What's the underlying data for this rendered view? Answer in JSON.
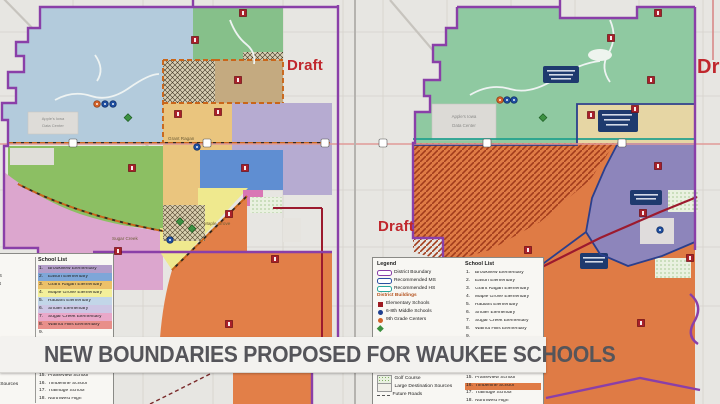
{
  "banner": {
    "text": "NEW BOUNDARIES PROPOSED FOR WAUKEE SCHOOLS"
  },
  "draft": "Draft",
  "legend": {
    "legend_header": "Legend",
    "school_list_header": "School List",
    "boundaries": [
      {
        "label": "District Boundary",
        "color": "#8a3fa8"
      },
      {
        "label": "Recommended MS",
        "color": "#2b4fa2"
      },
      {
        "label": "Recommended HS",
        "color": "#2aa79b"
      }
    ],
    "buildings_header": "District Buildings",
    "buildings": [
      {
        "label": "Elementary Schools",
        "color": "#9e1b22",
        "shape": "square"
      },
      {
        "label": "6-8th Middle Schools",
        "color": "#1f3f8f",
        "shape": "circle"
      },
      {
        "label": "9th Grade Centers",
        "color": "#d2622a",
        "shape": "circle"
      },
      {
        "label": "",
        "color": "#3a8f3e",
        "shape": "diamond"
      }
    ],
    "areas": [
      {
        "label": "Golf Course"
      },
      {
        "label": "Large Destination Sources"
      },
      {
        "label": "Future Roads"
      }
    ],
    "schools_upper": [
      {
        "num": "1.",
        "name": "Brookview Elementary",
        "hl": "#b39dc9"
      },
      {
        "num": "2.",
        "name": "Eason Elementary",
        "hl": "#7ea6d8"
      },
      {
        "num": "3.",
        "name": "Grant Ragan Elementary",
        "hl": "#ecc169"
      },
      {
        "num": "4.",
        "name": "Maple Grove Elementary",
        "hl": "#f3ef9a"
      },
      {
        "num": "5.",
        "name": "Radiant Elementary",
        "hl": "#c2d6e8"
      },
      {
        "num": "6.",
        "name": "Shuler Elementary",
        "hl": "#cdc6e4"
      },
      {
        "num": "7.",
        "name": "Sugar Creek Elementary",
        "hl": "#e9a8c9"
      },
      {
        "num": "8.",
        "name": "Walnut Hills Elementary",
        "hl": "#e88f8a"
      },
      {
        "num": "9.",
        "name": "",
        "hl": ""
      }
    ],
    "schools_lower": [
      {
        "num": "15.",
        "name": "Prairieview School"
      },
      {
        "num": "16.",
        "name": "Timberline School",
        "hl_right": "#e07b45"
      },
      {
        "num": "17.",
        "name": "Trailridge School"
      },
      {
        "num": "18.",
        "name": "Northwest High"
      }
    ]
  },
  "map_labels": {
    "data_center_line1": "Apple's Iowa",
    "data_center_line2": "Data Center",
    "grant_ragan": "Grant Ragan",
    "sugar_creek": "Sugar Creek",
    "maple_grove": "Maple Grove"
  },
  "palette": {
    "paper": "#e7e6e2",
    "radiant_blue": "#b3cbdc",
    "north_green": "#86c08a",
    "tan": "#c4aa80",
    "grant_ragan_gold": "#eac57e",
    "shuler_lavender": "#b6abd1",
    "eason_blue": "#5f8ed2",
    "west_green": "#8cbf63",
    "sugar_creek_pink": "#dca6ce",
    "maple_grove_yellow": "#efe98e",
    "brookview_purple": "#998cc4",
    "orange_zone": "#e27f48",
    "magenta_patch": "#d977b5",
    "right_green": "#8fc9a1",
    "right_tan": "#e6d6a4",
    "right_purple": "#8d85bb",
    "right_orange": "#df7b45",
    "district_boundary": "#8a3fa8",
    "recommended_ms": "#2b3f8c",
    "recommended_hs": "#21a08e",
    "major_road": "#9c1a2e",
    "draft_red": "#c0272d"
  }
}
